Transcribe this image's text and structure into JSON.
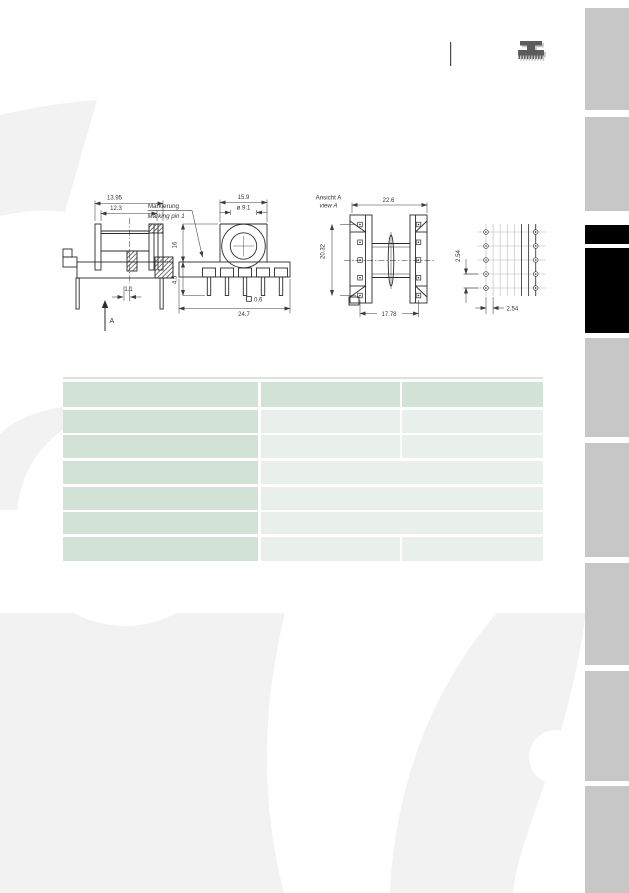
{
  "page": {
    "background": "#ffffff"
  },
  "header": {
    "icon": "coil-former-icon",
    "divider": true
  },
  "drawings": {
    "side_view": {
      "dim_outer_width": "13.95",
      "dim_inner_width": "12.3",
      "dim_pin_offset": "1.1",
      "view_arrow_label": "A"
    },
    "front_view": {
      "marking_label_de": "Markierung",
      "marking_label_en": "Marking pin 1",
      "dim_top_width": "15.9",
      "dim_hole_diameter": "ø 9.1",
      "dim_body_height": "16",
      "dim_pin_length": "4.5",
      "dim_total_width": "24.7",
      "dim_pin_square": "0.6"
    },
    "view_a": {
      "label_de": "Ansicht A",
      "label_en": "view A",
      "dim_width": "22.6",
      "dim_pin_column_span": "20.32",
      "dim_pin_row_span": "17.78"
    },
    "pin_grid": {
      "dim_vertical_pitch": "2.54",
      "dim_horizontal_pitch": "2.54"
    }
  },
  "table": {
    "columns": 3,
    "row_count": 7,
    "cells_text": "",
    "rows_shading": [
      [
        "medium",
        "medium",
        "medium"
      ],
      [
        "medium",
        "light",
        "light"
      ],
      [
        "medium",
        "light",
        "light"
      ],
      [
        "medium",
        "light-merged"
      ],
      [
        "medium",
        "light-merged"
      ],
      [
        "medium",
        "light-merged"
      ],
      [
        "medium",
        "light",
        "light"
      ]
    ]
  },
  "sidebar": {
    "tab_count": 9,
    "tabs": [
      {
        "state": "inactive"
      },
      {
        "state": "inactive"
      },
      {
        "state": "active"
      },
      {
        "state": "active"
      },
      {
        "state": "inactive"
      },
      {
        "state": "inactive"
      },
      {
        "state": "inactive"
      },
      {
        "state": "inactive"
      },
      {
        "state": "inactive"
      }
    ]
  },
  "colors": {
    "table_medium_green": "#d3e2d7",
    "table_light_green": "#e9f0eb",
    "table_top_rule": "#d9e5dc",
    "sidebar_tab_gray": "#c7c7c7",
    "sidebar_tab_active": "#000000",
    "watermark_gray": "#f2f2f2",
    "drawing_line": "#2b2b2b",
    "icon_dark": "#5c5c5c",
    "icon_shadow": "#c6c6c6"
  }
}
